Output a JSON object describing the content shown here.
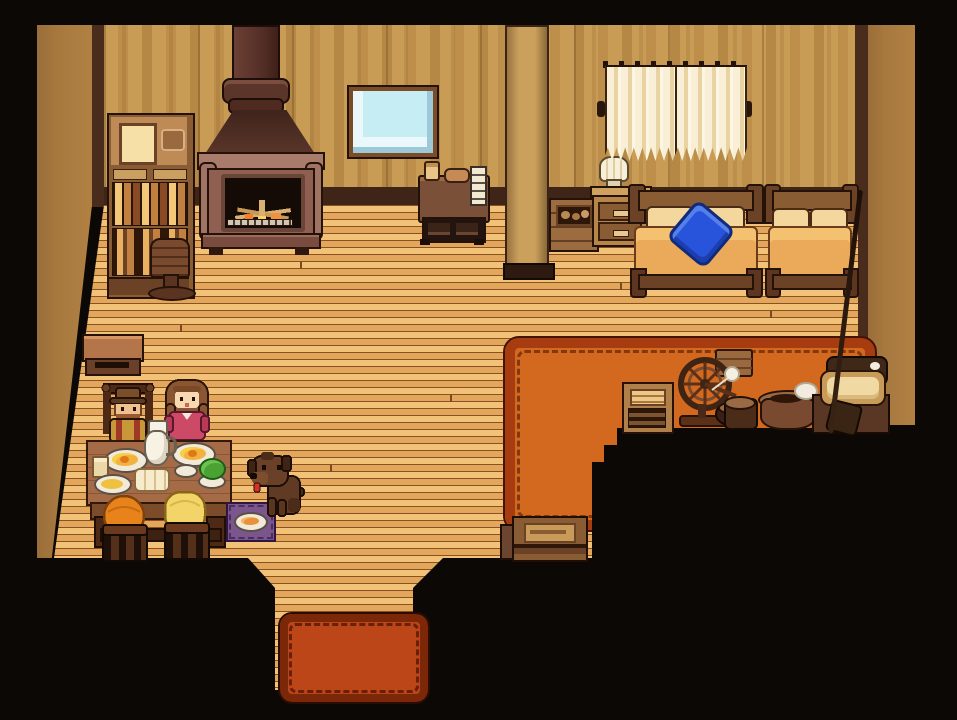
{
  "scene": {
    "name": "Pixel-art cabin interior",
    "caption": "Pixel-art farm-game cabin: wood stove with chimney, bookshelf, mirror, curtained window, two beds with a blue pillow, a family eating breakfast at a table, a brown puppy with a food dish, and craft machines on a large orange rug.",
    "palette": {
      "scene-bg": "#0b0805",
      "wallpaper": "#c99c55",
      "wallpaper-stripe": "#bd8f4b",
      "side-wall": "#a8793f",
      "wall-trim": "#4a2c1d",
      "baseboard": "#3f2518",
      "floor-light": "#f2c279",
      "floor-dark": "#e3a75c",
      "floor-line": "#8a5224",
      "rug-fill": "#d2691e",
      "rug-border": "#a63c10",
      "mat-fill": "#bc4617",
      "mat-border": "#7c2808",
      "pillow-blue": "#2754da",
      "mirror-glass": "#c6ecf4",
      "curtain": "#ead3a2",
      "bed-blanket": "#eaaa59",
      "stove-body": "#8f6052",
      "fire": "#f08030",
      "dog-brown": "#6b4028",
      "dress-red": "#cc4a66",
      "hair-orange": "#e8821a",
      "hair-blond": "#f2d468"
    },
    "objects": {
      "bookshelf": {
        "label": "Bookshelf cabinet with jars"
      },
      "stove": {
        "label": "Wood-burning stove"
      },
      "chimney": {
        "label": "Stove chimney pipe"
      },
      "mirror": {
        "label": "Wall mirror"
      },
      "desk": {
        "label": "Wooden dresser with notepad"
      },
      "pillar": {
        "label": "Support pillar"
      },
      "wallCrate": {
        "label": "Storage crate"
      },
      "nightstand": {
        "label": "Nightstand with drawers"
      },
      "lamp": {
        "label": "Table lamp"
      },
      "window": {
        "label": "Window with curtains"
      },
      "bedDouble": {
        "label": "Double bed"
      },
      "bluePillow": {
        "label": "Blue pillow"
      },
      "bedSingle": {
        "label": "Single bed"
      },
      "sideTable": {
        "label": "Low side table"
      },
      "rockingChair": {
        "label": "Small chair"
      },
      "rug": {
        "label": "Large orange area rug"
      },
      "doormat": {
        "label": "Entrance doormat"
      },
      "diningTable": {
        "label": "Dining table with breakfast"
      },
      "grandfather": {
        "label": "Grandfather in hat"
      },
      "mother": {
        "label": "Mother in red dress"
      },
      "childOrange": {
        "label": "Child with orange hair"
      },
      "childBlond": {
        "label": "Child with blond hair"
      },
      "dog": {
        "label": "Brown puppy"
      },
      "dogDish": {
        "label": "Dog food dish on mat"
      },
      "applianceBox": {
        "label": "Small appliance"
      },
      "spinningWheel": {
        "label": "Spinning wheel"
      },
      "cookingPot": {
        "label": "Cooking pot"
      },
      "millBasin": {
        "label": "Mill basin"
      },
      "butterChurn": {
        "label": "Churn machine"
      },
      "fishingRod": {
        "label": "Fishing rod"
      },
      "floorCrate": {
        "label": "Wooden crate"
      },
      "floor": {
        "label": "Wooden plank floor"
      },
      "entrance": {
        "label": "Entrance walkway"
      }
    }
  }
}
